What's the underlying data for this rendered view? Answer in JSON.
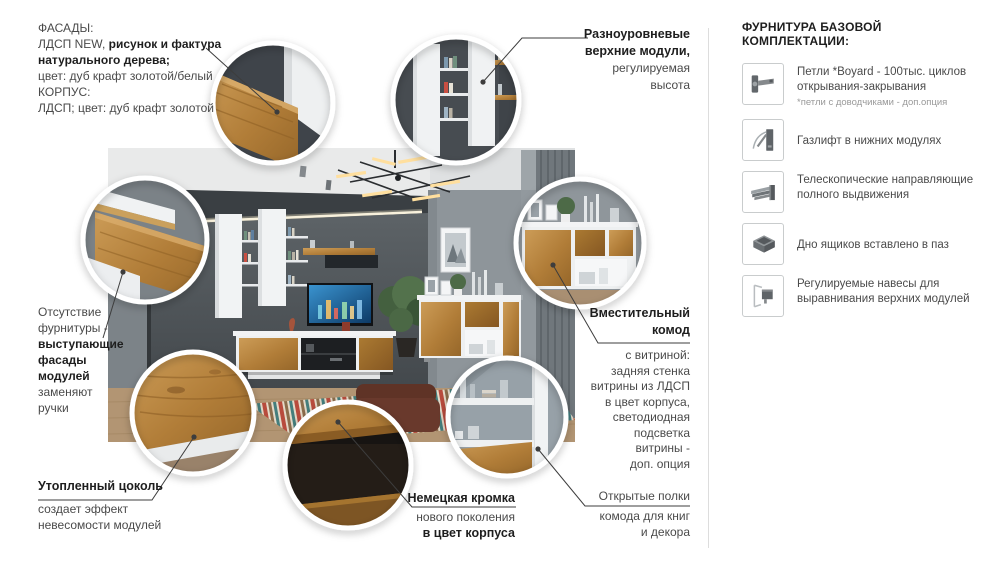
{
  "facades": {
    "l1": "ФАСАДЫ:",
    "l2_regular": "ЛДСП NEW, ",
    "l2_bold": "рисунок и фактура",
    "l3_bold": "натурального дерева;",
    "l4": "цвет: дуб крафт золотой/белый",
    "l5": "КОРПУС:",
    "l6": "ЛДСП; цвет: дуб крафт золотой"
  },
  "top_modules": {
    "b1": "Разноуровневые",
    "b2": "верхние модули,",
    "r1": "регулируемая",
    "r2": "высота"
  },
  "no_handles": {
    "r1": "Отсутствие",
    "r2": "фурнитуры -",
    "b1": "выступающие",
    "b2": "фасады",
    "b3": "модулей",
    "r3": "заменяют",
    "r4": "ручки"
  },
  "plinth": {
    "b1": "Утопленный цоколь",
    "r1": "создает эффект",
    "r2": "невесомости модулей"
  },
  "edge": {
    "b1": "Немецкая кромка",
    "r1": "нового поколения",
    "b2": "в цвет корпуса"
  },
  "commode": {
    "b1": "Вместительный",
    "b2": "комод",
    "r1": "с  витриной:",
    "r2": "задняя стенка",
    "r3": "витрины из ЛДСП",
    "r4": "в цвет корпуса,",
    "r5": "светодиодная",
    "r6": "подсветка",
    "r7": "витрины -",
    "r8": "доп. опция"
  },
  "open_shelves": {
    "r1": "Открытые полки",
    "r2": "комода для книг",
    "r3": "и декора"
  },
  "hardware": {
    "title": "ФУРНИТУРА БАЗОВОЙ КОМПЛЕКТАЦИИ:",
    "items": [
      {
        "icon": "hinge-icon",
        "line1": "Петли *Boyard - 100тыс. циклов",
        "line2": "открывания-закрывания",
        "note": "*петли с доводчиками - доп.опция"
      },
      {
        "icon": "gas-lift-icon",
        "line1": "Газлифт в нижних модулях",
        "line2": "",
        "note": ""
      },
      {
        "icon": "telescopic-slides-icon",
        "line1": "Телескопические направляющие",
        "line2": "полного выдвижения",
        "note": ""
      },
      {
        "icon": "drawer-bottom-icon",
        "line1": "Дно ящиков вставлено в паз",
        "line2": "",
        "note": ""
      },
      {
        "icon": "cabinet-hanger-icon",
        "line1": "Регулируемые навесы для",
        "line2": "выравнивания верхних модулей",
        "note": ""
      }
    ]
  },
  "colors": {
    "wood": "#b17d38",
    "wall_dark": "#545a5e",
    "wall_light": "#8e959a",
    "text_bold": "#1e1e1e",
    "text_regular": "#4a4a4a",
    "leader_line": "#3d3d3d"
  }
}
